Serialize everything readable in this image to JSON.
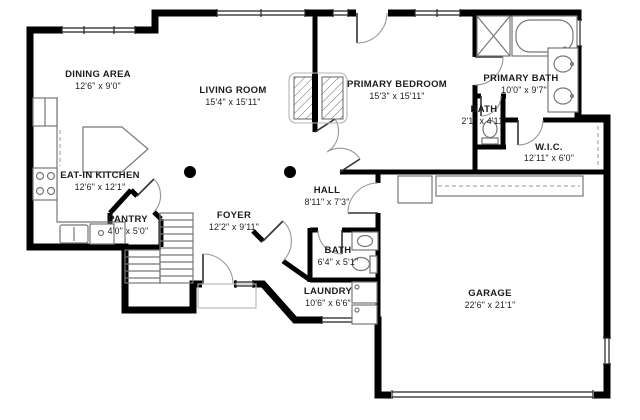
{
  "meta": {
    "kind": "residential-floor-plan",
    "background": "#ffffff",
    "wall_color": "#000000",
    "label_color": "#1c1c1c",
    "fixture_color": "#8c8c8c"
  },
  "rooms": [
    {
      "name": "DINING AREA",
      "dims": "12'6\" x 9'0\""
    },
    {
      "name": "LIVING ROOM",
      "dims": "15'4\" x 15'11\""
    },
    {
      "name": "PRIMARY BEDROOM",
      "dims": "15'3\" x 15'11\""
    },
    {
      "name": "PRIMARY BATH",
      "dims": "10'0\" x 9'7\""
    },
    {
      "name": "BATH",
      "dims": "2'1\" x 4'11\""
    },
    {
      "name": "W.I.C.",
      "dims": "12'11\" x 6'0\""
    },
    {
      "name": "EAT-IN KITCHEN",
      "dims": "12'6\" x 12'1\""
    },
    {
      "name": "PANTRY",
      "dims": "4'0\" x 5'0\""
    },
    {
      "name": "FOYER",
      "dims": "12'2\" x 9'11\""
    },
    {
      "name": "HALL",
      "dims": "8'11\" x 7'3\""
    },
    {
      "name": "BATH",
      "dims": "6'4\" x 5'1\""
    },
    {
      "name": "LAUNDRY",
      "dims": "10'6\" x 6'6\""
    },
    {
      "name": "GARAGE",
      "dims": "22'6\" x 21'1\""
    }
  ]
}
